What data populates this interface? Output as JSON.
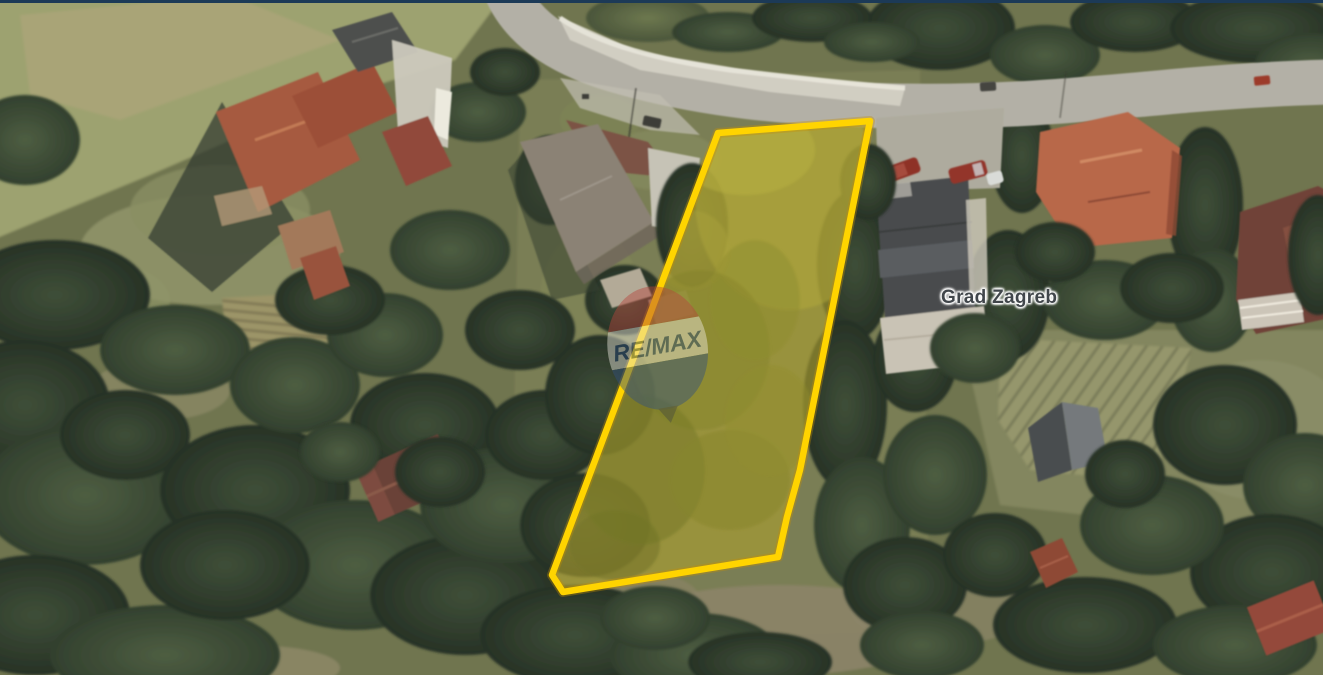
{
  "map": {
    "type": "satellite-view",
    "place_label": "Grad Zagreb",
    "watermark": "RE/MAX",
    "border_top_color": "#1c3a57",
    "parcel": {
      "outline_color": "#FFD400",
      "outline_underglow": "#C79000",
      "fill_tint": "rgba(255,214,0,0.16)",
      "points": "718,133 870,121 800,470 787,517 778,557 563,592 552,575"
    }
  }
}
